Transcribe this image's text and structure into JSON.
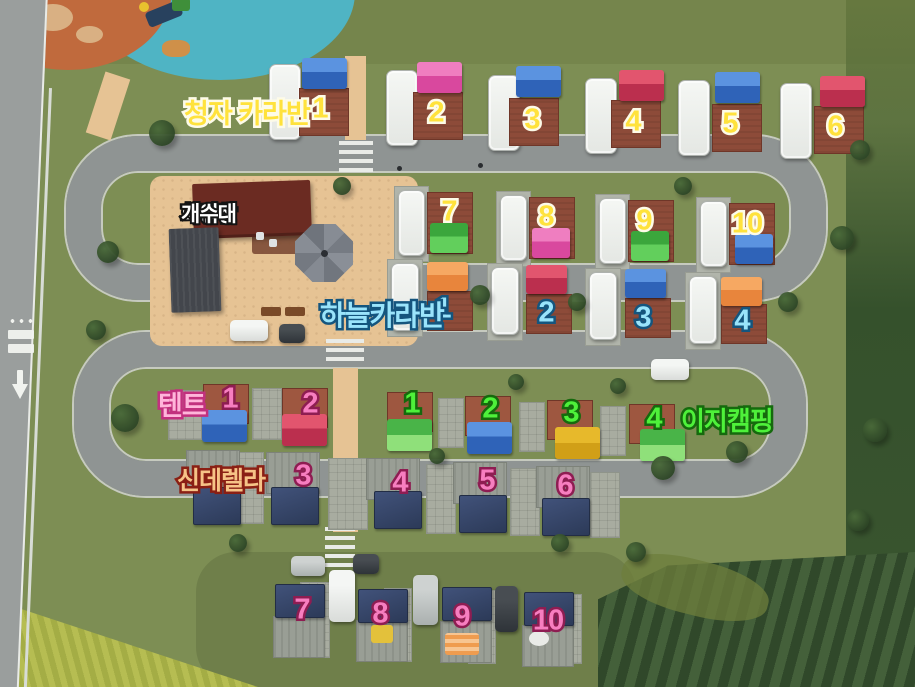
{
  "legend": {
    "cheongja_label": "청자 카라반",
    "facilities": [
      "화장실",
      "샤워장",
      "개수대"
    ],
    "haneul_label": "하늘카라반",
    "tent_label": "텐트",
    "easy_label": "이지캠핑",
    "cinderella_label": "신데렐라"
  },
  "colors": {
    "cheongja_text": "#ffe23c",
    "haneul_text": "#9ae4fb",
    "easy_text": "#4ef13a",
    "tent_text": "#ffb5da",
    "cinderella_text": "#f6c387",
    "site_number_pink": "#f77ec0",
    "facilities_text": "#ffffff",
    "road": "#8f9493",
    "sand_plaza": "#e6c394",
    "grass": "#7d8e54"
  },
  "map": {
    "groups": [
      {
        "id": "cheongja-caravan",
        "num_style": "st-yellow",
        "caravan_size": [
          32,
          76
        ],
        "pad_size": [
          50,
          48
        ],
        "tent_size": [
          45,
          31
        ],
        "sites": [
          {
            "num": "1",
            "caravan": [
              269,
              64
            ],
            "tent": [
              302,
              58,
              "blue"
            ],
            "pad": [
              299,
              88
            ],
            "num_pos": [
              320,
              109
            ]
          },
          {
            "num": "2",
            "caravan": [
              386,
              70
            ],
            "tent": [
              417,
              62,
              "pink"
            ],
            "pad": [
              413,
              92
            ],
            "num_pos": [
              436,
              113
            ]
          },
          {
            "num": "3",
            "caravan": [
              488,
              75
            ],
            "tent": [
              516,
              66,
              "blue"
            ],
            "pad": [
              509,
              98
            ],
            "num_pos": [
              532,
              120
            ]
          },
          {
            "num": "4",
            "caravan": [
              585,
              78
            ],
            "tent": [
              619,
              70,
              "red"
            ],
            "pad": [
              611,
              100
            ],
            "num_pos": [
              633,
              122
            ]
          },
          {
            "num": "5",
            "caravan": [
              678,
              80
            ],
            "tent": [
              715,
              72,
              "blue"
            ],
            "pad": [
              712,
              104
            ],
            "num_pos": [
              730,
              124
            ]
          },
          {
            "num": "6",
            "caravan": [
              780,
              83
            ],
            "tent": [
              820,
              76,
              "red"
            ],
            "pad": [
              814,
              106
            ],
            "num_pos": [
              835,
              127
            ]
          }
        ]
      },
      {
        "id": "haneul-caravan-upper",
        "num_style": "st-yellow",
        "strip": true,
        "caravan_size": [
          27,
          66
        ],
        "pad_size": [
          46,
          62
        ],
        "tent_size": [
          38,
          30
        ],
        "sites": [
          {
            "num": "7",
            "caravan": [
              398,
              190
            ],
            "pad": [
              427,
              192
            ],
            "tent": [
              430,
              223,
              "green"
            ],
            "num_pos": [
              449,
              212
            ]
          },
          {
            "num": "8",
            "caravan": [
              500,
              195
            ],
            "pad": [
              529,
              197
            ],
            "tent": [
              532,
              228,
              "pink"
            ],
            "num_pos": [
              546,
              217
            ]
          },
          {
            "num": "9",
            "caravan": [
              599,
              198
            ],
            "pad": [
              628,
              200
            ],
            "tent": [
              631,
              231,
              "green"
            ],
            "num_pos": [
              644,
              221
            ]
          },
          {
            "num": "10",
            "caravan": [
              700,
              201
            ],
            "pad": [
              729,
              203
            ],
            "tent": [
              735,
              234,
              "blue"
            ],
            "num_pos": [
              747,
              224
            ]
          }
        ]
      },
      {
        "id": "haneul-caravan-lower",
        "num_style": "st-cyan",
        "strip": true,
        "caravan_size": [
          28,
          68
        ],
        "pad_size": [
          46,
          40
        ],
        "tent_size": [
          41,
          29
        ],
        "sites": [
          {
            "num": "1",
            "caravan": [
              391,
              263
            ],
            "tent": [
              427,
              262,
              "orange"
            ],
            "pad": [
              427,
              291
            ],
            "num_pos": [
              443,
              309
            ]
          },
          {
            "num": "2",
            "caravan": [
              491,
              267
            ],
            "tent": [
              526,
              265,
              "red"
            ],
            "pad": [
              526,
              294
            ],
            "num_pos": [
              546,
              313
            ]
          },
          {
            "num": "3",
            "caravan": [
              589,
              272
            ],
            "tent": [
              625,
              269,
              "blue"
            ],
            "pad": [
              625,
              298
            ],
            "num_pos": [
              643,
              318
            ]
          },
          {
            "num": "4",
            "caravan": [
              689,
              276
            ],
            "tent": [
              721,
              277,
              "orange"
            ],
            "pad": [
              721,
              304
            ],
            "num_pos": [
              742,
              321
            ]
          }
        ]
      },
      {
        "id": "tent-sites",
        "num_style": "st-pink",
        "pad_cls": "pad-warm",
        "pad_size": [
          46,
          40
        ],
        "tent_size": [
          45,
          32
        ],
        "sites": [
          {
            "num": "1",
            "pad": [
              203,
              384
            ],
            "tent": [
              202,
              410,
              "blue"
            ],
            "num_pos": [
              230,
              399
            ]
          },
          {
            "num": "2",
            "pad": [
              282,
              388
            ],
            "tent": [
              282,
              414,
              "red"
            ],
            "num_pos": [
              310,
              404
            ]
          }
        ]
      },
      {
        "id": "easy-camping",
        "num_style": "st-green",
        "pad_cls": "pad-warm",
        "pad_size": [
          46,
          40
        ],
        "tent_size": [
          45,
          32
        ],
        "sites": [
          {
            "num": "1",
            "pad": [
              387,
              392
            ],
            "tent": [
              387,
              419,
              "lgreen"
            ],
            "num_pos": [
              412,
              404
            ]
          },
          {
            "num": "2",
            "pad": [
              465,
              396
            ],
            "tent": [
              467,
              422,
              "blue"
            ],
            "num_pos": [
              490,
              409
            ]
          },
          {
            "num": "3",
            "pad": [
              547,
              400
            ],
            "tent": [
              555,
              427,
              "yellow"
            ],
            "num_pos": [
              571,
              413
            ]
          },
          {
            "num": "4",
            "pad": [
              629,
              404
            ],
            "tent": [
              640,
              429,
              "lgreen"
            ],
            "num_pos": [
              654,
              419
            ]
          }
        ]
      },
      {
        "id": "cinderella-sites",
        "num_style": "st-pink",
        "deck_size": [
          54,
          42
        ],
        "tarp_size": [
          48,
          38
        ],
        "sites": [
          {
            "deck": [
              186,
              450
            ],
            "tarp": [
              193,
              487
            ]
          },
          {
            "num": "3",
            "deck": [
              266,
              452
            ],
            "tarp": [
              271,
              487
            ],
            "num_pos": [
              303,
              476
            ]
          },
          {
            "num": "4",
            "deck": [
              366,
              458
            ],
            "tarp": [
              374,
              491
            ],
            "num_pos": [
              400,
              483
            ]
          },
          {
            "num": "5",
            "deck": [
              453,
              462
            ],
            "tarp": [
              459,
              495
            ],
            "num_pos": [
              487,
              481
            ]
          },
          {
            "num": "6",
            "deck": [
              536,
              466
            ],
            "tarp": [
              542,
              498
            ],
            "num_pos": [
              565,
              486
            ]
          }
        ]
      },
      {
        "id": "cinderella-sites-bottom",
        "num_style": "st-pink",
        "deck_size": [
          52,
          42
        ],
        "tarp_size": [
          50,
          34
        ],
        "sites": [
          {
            "num": "7",
            "tarp": [
              275,
              584
            ],
            "deck": [
              273,
              616
            ],
            "num_pos": [
              302,
              610
            ]
          },
          {
            "num": "8",
            "tarp": [
              358,
              589
            ],
            "deck": [
              356,
              620
            ],
            "num_pos": [
              380,
              614
            ]
          },
          {
            "num": "9",
            "tarp": [
              442,
              587
            ],
            "deck": [
              440,
              621
            ],
            "num_pos": [
              462,
              617
            ]
          },
          {
            "num": "10",
            "tarp": [
              524,
              592
            ],
            "deck": [
              522,
              625
            ],
            "num_pos": [
              548,
              621
            ]
          }
        ]
      }
    ],
    "gravel": [
      [
        168,
        390,
        34,
        50
      ],
      [
        252,
        388,
        30,
        52
      ],
      [
        438,
        398,
        26,
        50
      ],
      [
        519,
        402,
        26,
        50
      ],
      [
        600,
        406,
        26,
        50
      ],
      [
        228,
        452,
        36,
        72
      ],
      [
        328,
        458,
        40,
        72
      ],
      [
        426,
        464,
        30,
        70
      ],
      [
        510,
        468,
        30,
        68
      ],
      [
        590,
        472,
        30,
        66
      ],
      [
        300,
        582,
        30,
        76
      ],
      [
        384,
        588,
        28,
        74
      ],
      [
        468,
        590,
        28,
        74
      ],
      [
        552,
        594,
        30,
        70
      ]
    ],
    "benches": [
      [
        261,
        307
      ],
      [
        285,
        307
      ]
    ],
    "accents": [
      {
        "x": 371,
        "y": 625,
        "w": 22,
        "h": 18,
        "kind": "acc-yellow"
      },
      {
        "x": 445,
        "y": 633,
        "w": 34,
        "h": 22,
        "kind": "acc-orange"
      },
      {
        "x": 529,
        "y": 631,
        "w": 20,
        "h": 15,
        "kind": "acc-white"
      }
    ],
    "cars": [
      {
        "x": 230,
        "y": 320,
        "w": 38,
        "h": 21,
        "c": "white"
      },
      {
        "x": 279,
        "y": 324,
        "w": 26,
        "h": 19,
        "c": "dark"
      },
      {
        "x": 651,
        "y": 359,
        "w": 38,
        "h": 21,
        "c": "white"
      },
      {
        "x": 291,
        "y": 556,
        "w": 34,
        "h": 20,
        "c": "silver"
      },
      {
        "x": 353,
        "y": 554,
        "w": 26,
        "h": 20,
        "c": "dark"
      },
      {
        "x": 329,
        "y": 570,
        "w": 26,
        "h": 52,
        "c": "white"
      },
      {
        "x": 413,
        "y": 575,
        "w": 25,
        "h": 50,
        "c": "silver"
      },
      {
        "x": 495,
        "y": 586,
        "w": 23,
        "h": 46,
        "c": "dark"
      }
    ],
    "trees": [
      [
        162,
        133,
        13
      ],
      [
        108,
        252,
        11
      ],
      [
        96,
        330,
        10
      ],
      [
        125,
        418,
        14
      ],
      [
        342,
        186,
        9
      ],
      [
        480,
        295,
        10
      ],
      [
        577,
        302,
        9
      ],
      [
        683,
        186,
        9
      ],
      [
        788,
        302,
        10
      ],
      [
        842,
        238,
        12
      ],
      [
        860,
        150,
        10
      ],
      [
        663,
        468,
        12
      ],
      [
        737,
        452,
        11
      ],
      [
        560,
        543,
        9
      ],
      [
        636,
        552,
        10
      ],
      [
        238,
        543,
        9
      ],
      [
        437,
        456,
        8
      ],
      [
        516,
        382,
        8
      ],
      [
        618,
        386,
        8
      ],
      [
        875,
        430,
        12
      ],
      [
        858,
        520,
        11
      ]
    ],
    "people": [
      [
        397,
        166
      ],
      [
        478,
        163
      ]
    ]
  }
}
